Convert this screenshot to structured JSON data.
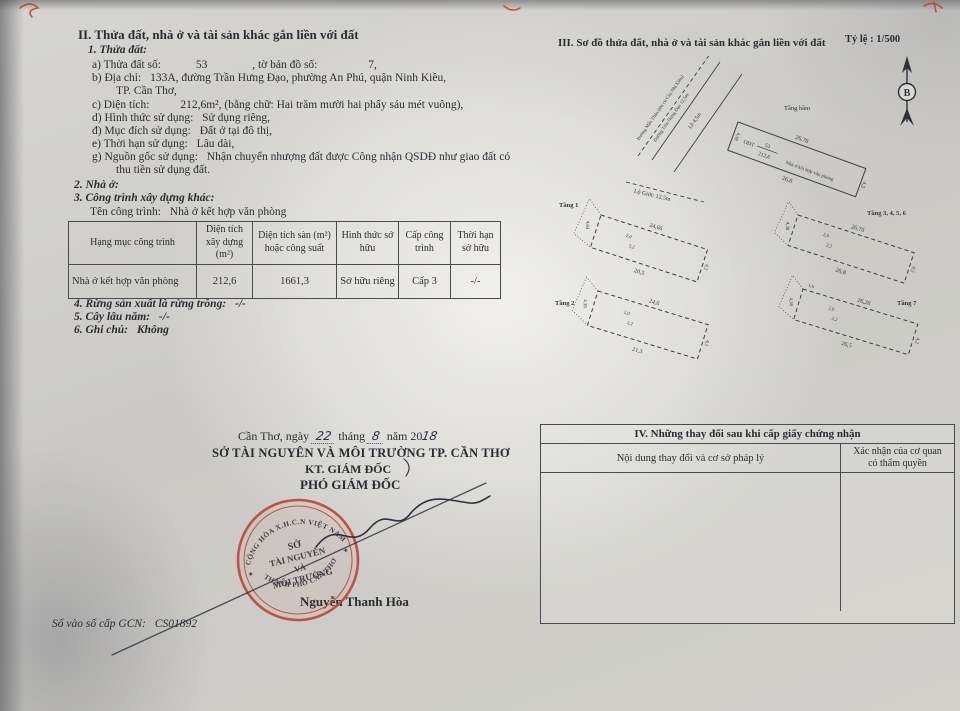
{
  "section_ii": {
    "title": "II. Thửa đất, nhà ở và tài sản khác gắn liền với đất",
    "sub1_title": "1. Thửa đất:",
    "items": [
      {
        "label": "a) Thửa đất số:",
        "value": "53",
        "label2": ", tờ bản đồ số:",
        "value2": "7,"
      },
      {
        "label": "b) Địa chỉ:",
        "value": "133A, đường Trần Hưng Đạo, phường An Phú, quận Ninh Kiều,",
        "value_cont": "TP. Cần Thơ,"
      },
      {
        "label": "c) Diện tích:",
        "value": "212,6m², (bằng chữ: Hai trăm mười hai phẩy sáu mét vuông),"
      },
      {
        "label": "d) Hình thức sử dụng:",
        "value": "Sử dụng riêng,"
      },
      {
        "label": "đ) Mục đích sử dụng:",
        "value": "Đất ở tại đô thị,"
      },
      {
        "label": "e) Thời hạn sử dụng:",
        "value": "Lâu dài,"
      },
      {
        "label": "g) Nguồn gốc sử dụng:",
        "value": "Nhận chuyển nhượng đất được Công nhận QSDĐ như giao đất có",
        "value_cont": "thu tiền sử dụng đất."
      }
    ],
    "sub2_title": "2. Nhà ở:",
    "sub3_title": "3. Công trình xây dựng khác:",
    "construction_name_label": "Tên công trình:",
    "construction_name": "Nhà ở kết hợp văn phòng",
    "table": {
      "headers": [
        "Hạng mục công trình",
        "Diện tích xây dựng (m²)",
        "Diện tích sàn (m²) hoặc công suất",
        "Hình thức sở hữu",
        "Cấp công trình",
        "Thời hạn sở hữu"
      ],
      "row": [
        "Nhà ở kết hợp văn phòng",
        "212,6",
        "1661,3",
        "Sở hữu riêng",
        "Cấp 3",
        "-/-"
      ]
    },
    "sub4_label": "4. Rừng sản xuất là rừng trồng:",
    "sub4_value": "-/-",
    "sub5_label": "5. Cây lâu năm:",
    "sub5_value": "-/-",
    "sub6_label": "6. Ghi chú:",
    "sub6_value": "Không"
  },
  "section_iii": {
    "title": "III. Sơ đồ thửa đất, nhà ở và tài sản khác gắn liền với đất",
    "scale": "Tỷ lệ : 1/500",
    "north_label": "B",
    "site": {
      "road_line1": "Đường Mậu Thân (tên cũ Cầu Nhị Kiều)",
      "road_line2": "Đường Trần Hưng Đạo 12,5m",
      "sidewalk": "Lề 4,5m",
      "road_width": "Lộ Giới: 12,5m",
      "basement": "Tầng hầm",
      "use_code": "ODT",
      "parcel_no": "53",
      "area": "212,6",
      "building": "Nhà ở kết hợp văn phòng",
      "dim_top": "26,76",
      "dim_bottom": "26,8",
      "dim_left": "4,38",
      "dim_right": "4,2"
    },
    "floors": [
      {
        "name": "Tầng 1",
        "dim_top": "24,66",
        "dim_bottom": "20,5",
        "dim_left": "4,64",
        "dim_right": "4,2",
        "jog1": "2,0",
        "jog2": "2,2"
      },
      {
        "name": "Tầng 2",
        "dim_top": "24,6",
        "dim_bottom": "21,3",
        "dim_left": "4,38",
        "dim_right": "4,2",
        "jog1": "2,0",
        "jog2": "2,2"
      },
      {
        "name": "Tầng 3, 4, 5, 6",
        "dim_top": "26,76",
        "dim_bottom": "26,8",
        "dim_left": "4,38",
        "dim_right": "4,2",
        "jog1": "2,0",
        "jog2": "2,2"
      },
      {
        "name": "Tầng 7",
        "dim_top": "26,26",
        "dim_bottom": "26,5",
        "dim_left": "4,38",
        "dim_right": "4,2",
        "jog1": "2,0",
        "jog2": "2,2",
        "extra": "1,6"
      }
    ]
  },
  "section_iv": {
    "title": "IV. Những thay đổi sau khi cấp giấy chứng nhận",
    "col1": "Nội dung thay đổi và cơ sở pháp lý",
    "col2_line1": "Xác nhận của cơ quan",
    "col2_line2": "có thẩm quyền"
  },
  "signature": {
    "date_prefix": "Cần Thơ, ngày",
    "date_day": "22",
    "date_mid": "tháng",
    "date_month": "8",
    "date_year_prefix": "năm 20",
    "date_year_suffix": "18",
    "department": "SỞ TÀI NGUYÊN VÀ MÔI TRƯỜNG TP. CẦN THƠ",
    "on_behalf": "KT. GIÁM ĐỐC",
    "title": "PHÓ GIÁM ĐỐC",
    "signer": "Nguyễn Thanh Hòa",
    "stamp": {
      "arc_top": "CỘNG HÒA X.H.C.N VIỆT NAM",
      "arc_bottom": "THÀNH PHỐ CẦN THƠ",
      "center1": "SỞ",
      "center2": "TÀI NGUYÊN",
      "center3": "VÀ",
      "center4": "MÔI TRƯỜNG",
      "star": "★"
    }
  },
  "footer": {
    "gcn_label": "Số vào sổ cấp GCN:",
    "gcn_value": "CS01892"
  }
}
